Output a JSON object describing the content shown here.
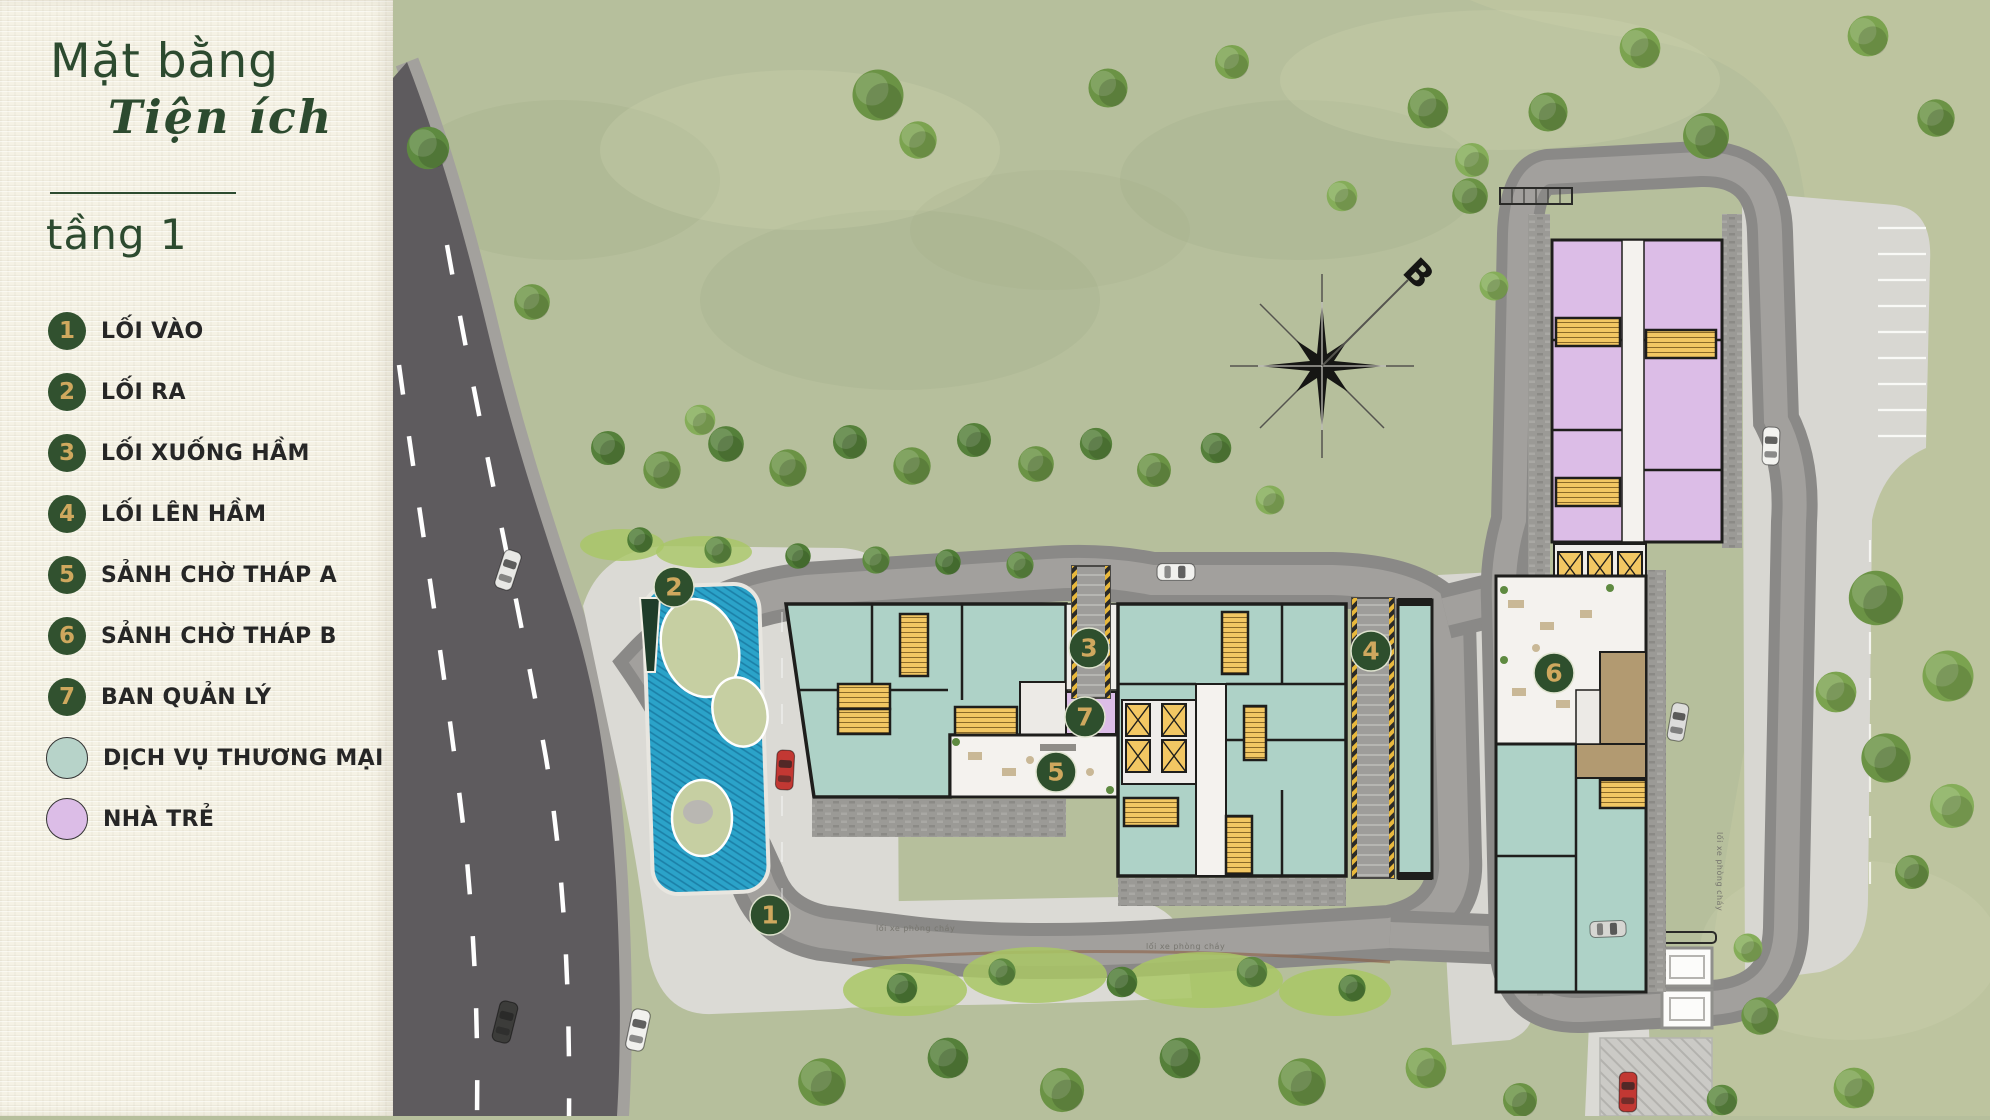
{
  "panel": {
    "title_line1": "Mặt bằng",
    "title_line2": "Tiện ích",
    "floor_label": "tầng 1",
    "legend": [
      {
        "number": "1",
        "label": "LỐI VÀO"
      },
      {
        "number": "2",
        "label": "LỐI RA"
      },
      {
        "number": "3",
        "label": "LỐI XUỐNG HẦM"
      },
      {
        "number": "4",
        "label": "LỐI LÊN HẦM"
      },
      {
        "number": "5",
        "label": "SẢNH CHỜ THÁP A"
      },
      {
        "number": "6",
        "label": "SẢNH CHỜ THÁP B"
      },
      {
        "number": "7",
        "label": "BAN QUẢN LÝ"
      }
    ],
    "swatches": [
      {
        "label": "DỊCH VỤ THƯƠNG MẠI",
        "color": "#b7d3c9"
      },
      {
        "label": "NHÀ TRẺ",
        "color": "#dcbde7"
      }
    ]
  },
  "map": {
    "compass_label": "B",
    "markers": [
      "1",
      "2",
      "3",
      "4",
      "5",
      "6",
      "7"
    ],
    "road_labels": [
      "lối xe phòng cháy",
      "lối xe phòng cháy",
      "lối xe phòng cháy"
    ]
  },
  "colors": {
    "panel_background": "#f5f2e5",
    "title_green": "#2c4a2f",
    "marker_green": "#2e4f2d",
    "marker_number_gold": "#cfa85e",
    "legend_text": "#262626",
    "grass": "#b6bf9c",
    "road_dark": "#5e5b5e",
    "paving_light": "#dbdad5",
    "building_commercial_teal": "#aed2c7",
    "building_nursery_lavender": "#dcbde7",
    "stair_yellow": "#f2c763",
    "pond_blue": "#2ba3c9"
  }
}
